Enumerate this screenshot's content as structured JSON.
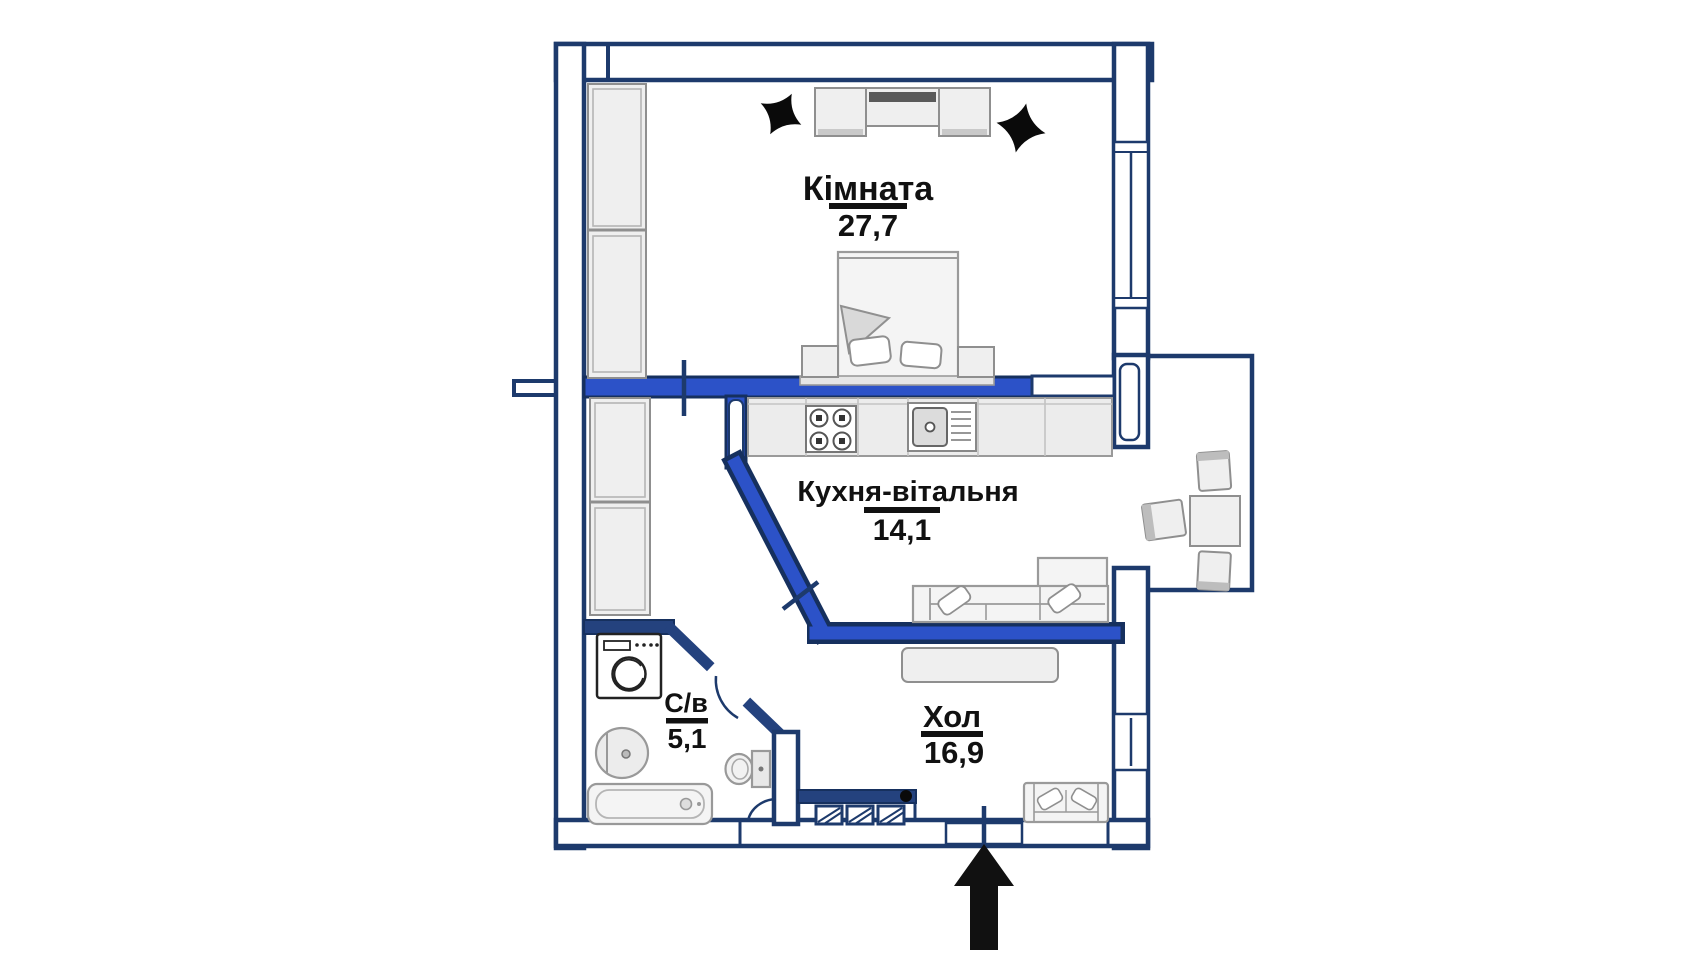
{
  "plan": {
    "title_hint": "apartment floor plan",
    "rooms": [
      {
        "name": "Кімната",
        "area": "27,7"
      },
      {
        "name": "Кухня-вітальня",
        "area": "14,1"
      },
      {
        "name": "Хол",
        "area": "16,9"
      },
      {
        "name": "С/в",
        "area": "5,1"
      }
    ],
    "entrance_marker": "entrance-arrow",
    "furniture": {
      "room": [
        "wardrobe",
        "tv-stand",
        "ceiling-light",
        "ceiling-light",
        "double-bed",
        "nightstand",
        "nightstand"
      ],
      "kitchen_living": [
        "wardrobe",
        "kitchen-counter",
        "stove",
        "kitchen-sink",
        "corner-sofa"
      ],
      "dining_nook": [
        "dining-table",
        "stool",
        "stool",
        "stool"
      ],
      "hall": [
        "console-table",
        "loveseat",
        "built-in-closet"
      ],
      "bathroom": [
        "washing-machine",
        "wash-basin",
        "toilet",
        "bathtub"
      ]
    },
    "colors": {
      "wall_navy": "#1d3a6c",
      "partition_blue": "#2c52c8",
      "partition_outline": "#16305e",
      "furniture_fill": "#efefef",
      "furniture_stroke": "#8f8f8f",
      "label_color": "#111111",
      "background": "#ffffff"
    }
  }
}
